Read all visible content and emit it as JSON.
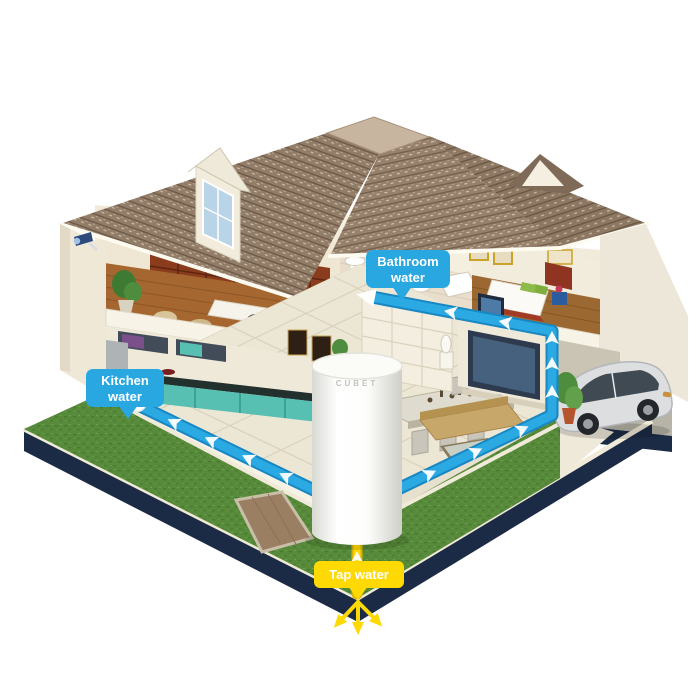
{
  "labels": {
    "bathroom": {
      "line1": "Bathroom",
      "line2": "water"
    },
    "kitchen": {
      "line1": "Kitchen",
      "line2": "water"
    },
    "tap": {
      "text": "Tap water"
    }
  },
  "tank": {
    "brand": "CUBET"
  },
  "colors": {
    "pipe_blue": "#2BA9E2",
    "label_blue": "#29A7E0",
    "tap_yellow": "#FFD903",
    "tap_yellow_dark": "#D9B400",
    "lawn_green": "#578A3A",
    "roof_brown": "#8A7663",
    "foundation_navy": "#1C2B45",
    "wall_cream": "#F2ECDC",
    "wood_brown": "#A5672F",
    "tank_white": "#FFFFFF",
    "car_silver": "#DCDEDF"
  }
}
